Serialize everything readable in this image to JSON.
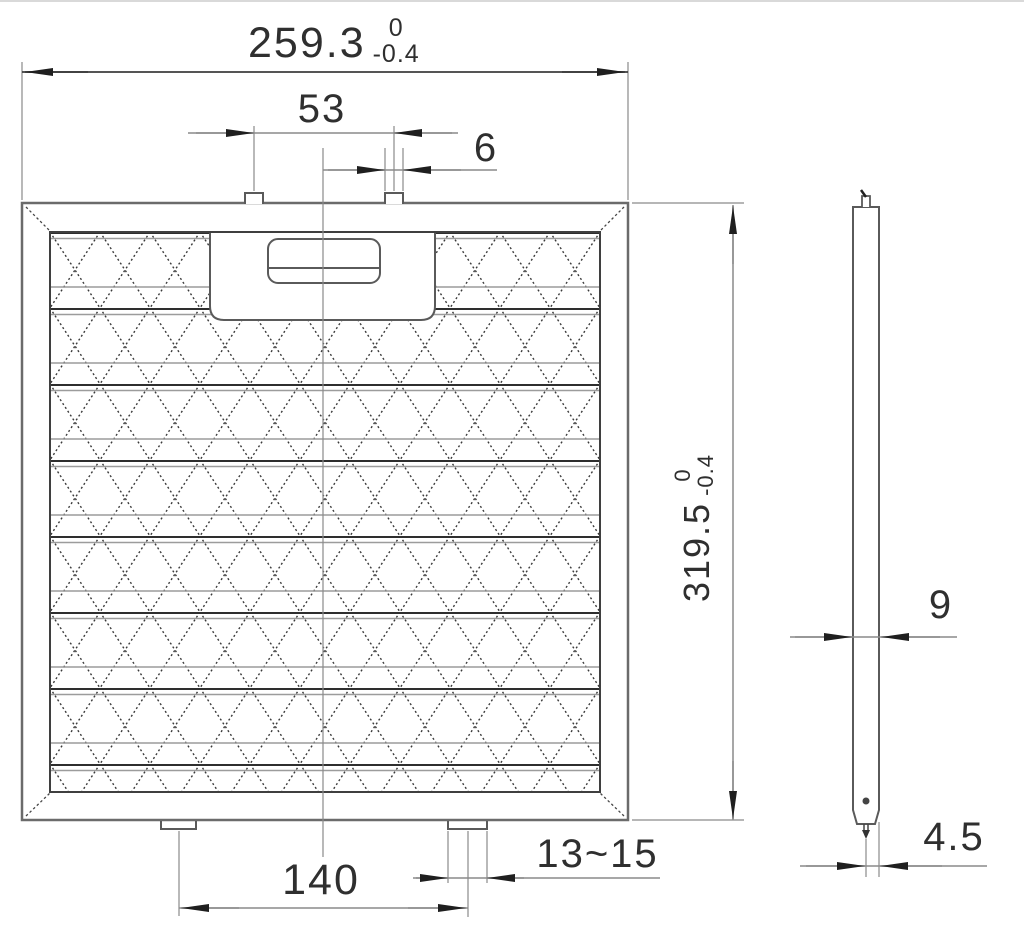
{
  "dimensions": {
    "overall_width": {
      "value": "259.3",
      "tol_upper": "0",
      "tol_lower": "-0.4"
    },
    "top_tab_spacing": {
      "value": "53"
    },
    "top_tab_width": {
      "value": "6"
    },
    "overall_height": {
      "value": "319.5",
      "tol_upper": "0",
      "tol_lower": "-0.4"
    },
    "bottom_tab_spacing": {
      "value": "140"
    },
    "bottom_tab_depth": {
      "value": "13~15"
    },
    "side_thickness": {
      "value": "9"
    },
    "side_pin_offset": {
      "value": "4.5"
    }
  }
}
